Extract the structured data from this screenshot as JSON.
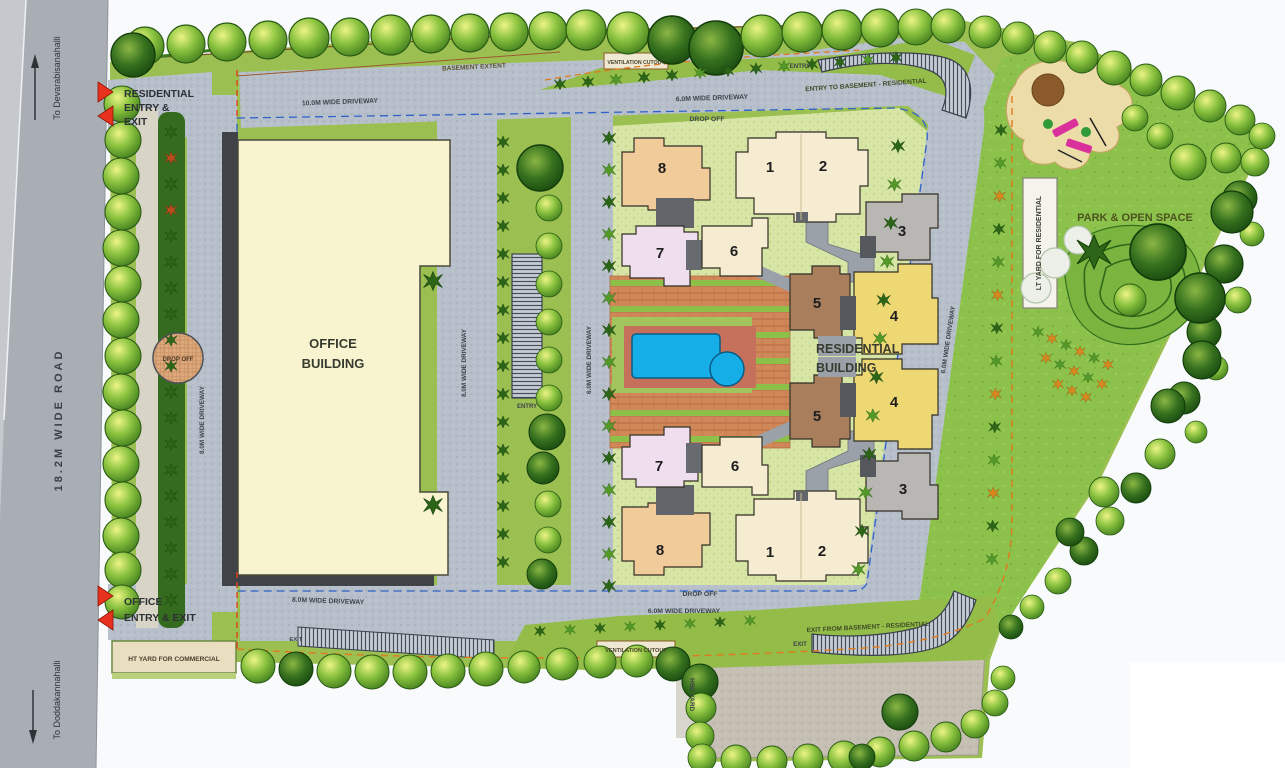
{
  "road": {
    "name": "18.2M WIDE ROAD",
    "north_destination": "To Devarabisanahalli",
    "south_destination": "To Doddakannahalli"
  },
  "access": {
    "residential_entry": [
      "RESIDENTIAL",
      "ENTRY &",
      "EXIT"
    ],
    "office_entry": [
      "OFFICE",
      "ENTRY & EXIT"
    ],
    "entry_top_right": "ENTRY",
    "entry_to_basement": "ENTRY TO BASEMENT - RESIDENTIAL",
    "entry_pool_walkway": "ENTRY",
    "exit_bottom_left": "EXIT",
    "exit_from_basement": "EXIT FROM BASEMENT - RESIDENTIAL",
    "exit_bottom_right": "EXIT"
  },
  "driveways": {
    "top_left": "10.0M WIDE DRIVEWAY",
    "top_right": "6.0M WIDE DRIVEWAY",
    "left_vertical": "8.0M WIDE DRIVEWAY",
    "center_left": "8.0M WIDE DRIVEWAY",
    "center_right": "6.0M WIDE DRIVEWAY",
    "right_diagonal": "6.0M WIDE DRIVEWAY",
    "bottom_left": "8.0M WIDE DRIVEWAY",
    "bottom_center": "6.0M WIDE DRIVEWAY"
  },
  "drop_off": {
    "top": "DROP OFF",
    "left_circle": "DROP OFF",
    "bottom": "DROP OFF"
  },
  "buildings": {
    "office": [
      "OFFICE",
      "BUILDING"
    ],
    "residential": [
      "RESIDENTIAL",
      "BUILDING"
    ],
    "tower_numbers": [
      "8",
      "1",
      "2",
      "3",
      "7",
      "6",
      "5",
      "4",
      "5",
      "4",
      "3",
      "7",
      "6",
      "8",
      "1",
      "2"
    ]
  },
  "zones": {
    "park": "PARK & OPEN SPACE",
    "lt_yard": "LT YARD FOR RESIDENTIAL",
    "ht_yard": "HT YARD FOR COMMERCIAL",
    "hsd_yard": "HSD YARD",
    "basement_extent": "BASEMENT EXTENT",
    "ventilation_cutout_top": "VENTILATION CUTOUT",
    "ventilation_cutout_bottom": "VENTILATION CUTOUT"
  },
  "palette": {
    "road": "#a9aeb5",
    "driveway": "#b7c0ca",
    "lawn": "#9cbf52",
    "park_lawn": "#8cc24c",
    "cluster_ground": "#d7e6a6",
    "office_fill": "#f8f4cf",
    "pool_water": "#16aee6",
    "deck": "#d08858",
    "tower_peach": "#f2cb9b",
    "tower_cream": "#f6ecd2",
    "tower_gray": "#b8b7b4",
    "tower_lavender": "#efdeee",
    "tower_brown": "#a87e5d",
    "tower_yellow": "#eed874",
    "arrow_red": "#e8321e",
    "boundary_blue": "#2f62c8",
    "boundary_orange": "#e07a1e"
  }
}
